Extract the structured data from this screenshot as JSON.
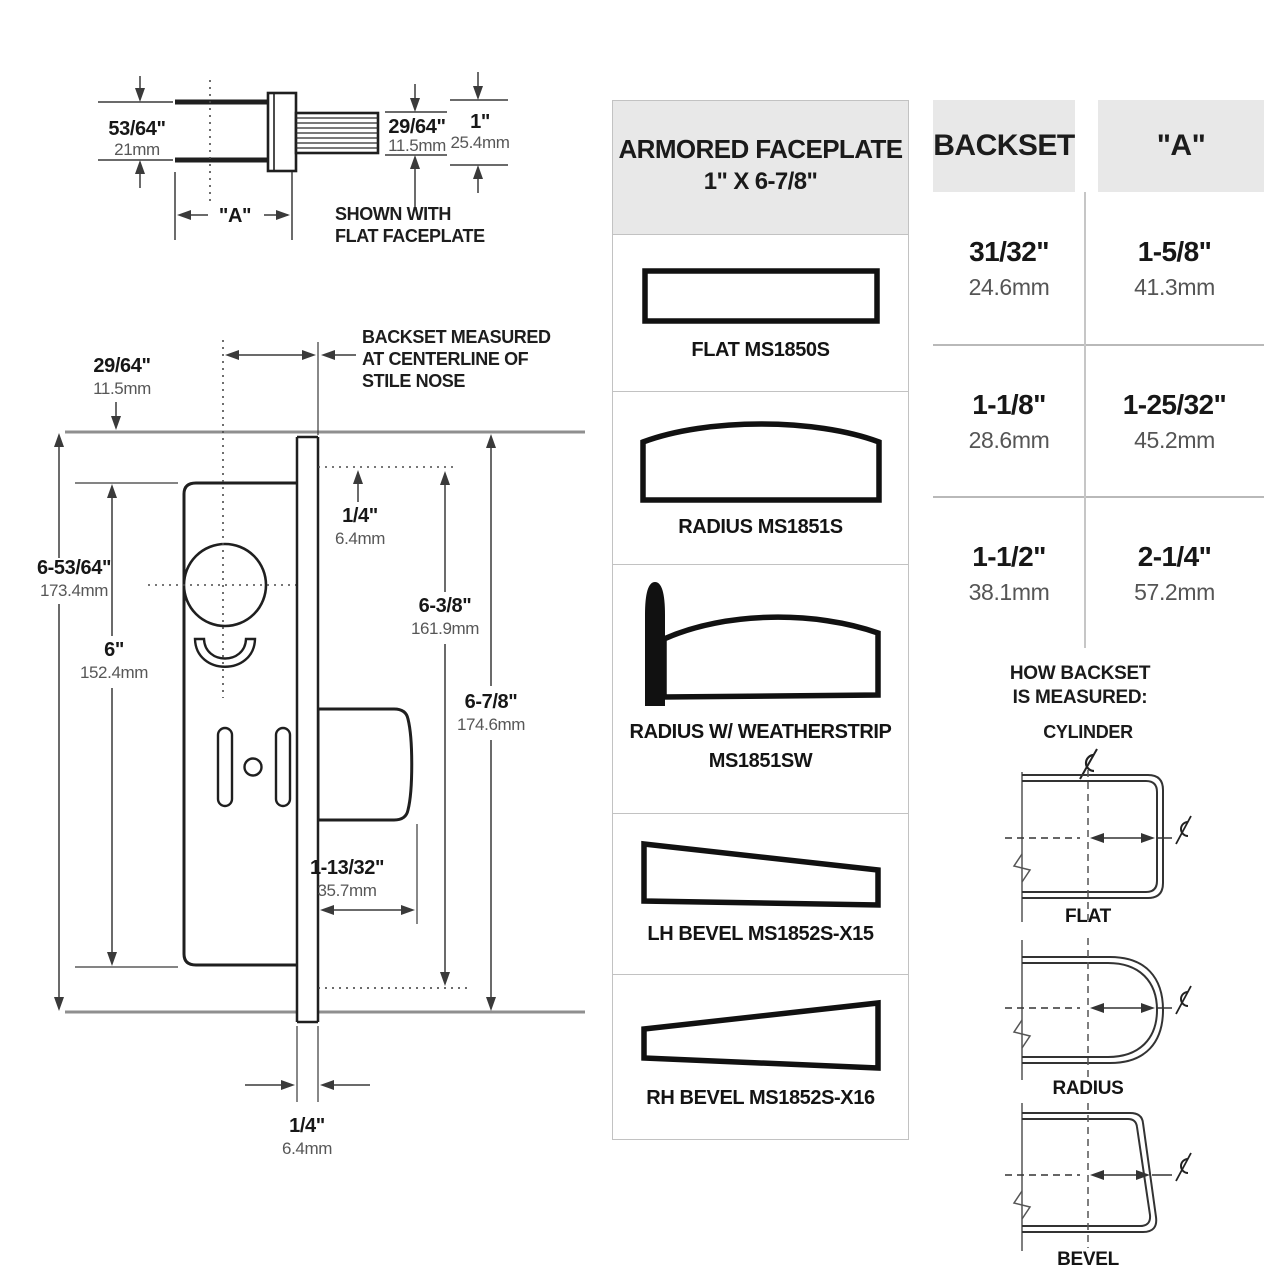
{
  "colors": {
    "drawing_line": "#1f1f1f",
    "dimension_line": "#3a3a3a",
    "structure_gray": "#8f8f8f",
    "panel_header_bg": "#e8e8e8",
    "mm_text": "#575757",
    "border_gray": "#c2c2c2"
  },
  "top_view": {
    "height_in": "53/64\"",
    "height_mm": "21mm",
    "bolt_in": "29/64\"",
    "bolt_mm": "11.5mm",
    "overall_in": "1\"",
    "overall_mm": "25.4mm",
    "a_label": "\"A\"",
    "caption_line1": "SHOWN WITH",
    "caption_line2": "FLAT FACEPLATE"
  },
  "front_view": {
    "note_line1": "BACKSET MEASURED",
    "note_line2": "AT CENTERLINE OF",
    "note_line3": "STILE NOSE",
    "stile_offset_in": "29/64\"",
    "stile_offset_mm": "11.5mm",
    "case_height_in": "6-53/64\"",
    "case_height_mm": "173.4mm",
    "case_inner_in": "6\"",
    "case_inner_mm": "152.4mm",
    "top_gap_in": "1/4\"",
    "top_gap_mm": "6.4mm",
    "faceplate_inner_in": "6-3/8\"",
    "faceplate_inner_mm": "161.9mm",
    "faceplate_in": "6-7/8\"",
    "faceplate_mm": "174.6mm",
    "bolt_throw_in": "1-13/32\"",
    "bolt_throw_mm": "35.7mm",
    "face_thickness_in": "1/4\"",
    "face_thickness_mm": "6.4mm"
  },
  "faceplate_panel": {
    "title_line1": "ARMORED FACEPLATE",
    "title_line2": "1\" X 6-7/8\"",
    "items": [
      {
        "label": "FLAT MS1850S"
      },
      {
        "label": "RADIUS MS1851S"
      },
      {
        "label": "RADIUS W/ WEATHERSTRIP",
        "label2": "MS1851SW"
      },
      {
        "label": "LH BEVEL MS1852S-X15"
      },
      {
        "label": "RH BEVEL MS1852S-X16"
      }
    ]
  },
  "backset_table": {
    "col1_header": "BACKSET",
    "col2_header": "\"A\"",
    "rows": [
      {
        "backset_in": "31/32\"",
        "backset_mm": "24.6mm",
        "a_in": "1-5/8\"",
        "a_mm": "41.3mm"
      },
      {
        "backset_in": "1-1/8\"",
        "backset_mm": "28.6mm",
        "a_in": "1-25/32\"",
        "a_mm": "45.2mm"
      },
      {
        "backset_in": "1-1/2\"",
        "backset_mm": "38.1mm",
        "a_in": "2-1/4\"",
        "a_mm": "57.2mm"
      }
    ]
  },
  "how_backset": {
    "title_line1": "HOW BACKSET",
    "title_line2": "IS MEASURED:",
    "cylinder_label": "CYLINDER",
    "flat_label": "FLAT",
    "radius_label": "RADIUS",
    "bevel_label": "BEVEL"
  }
}
